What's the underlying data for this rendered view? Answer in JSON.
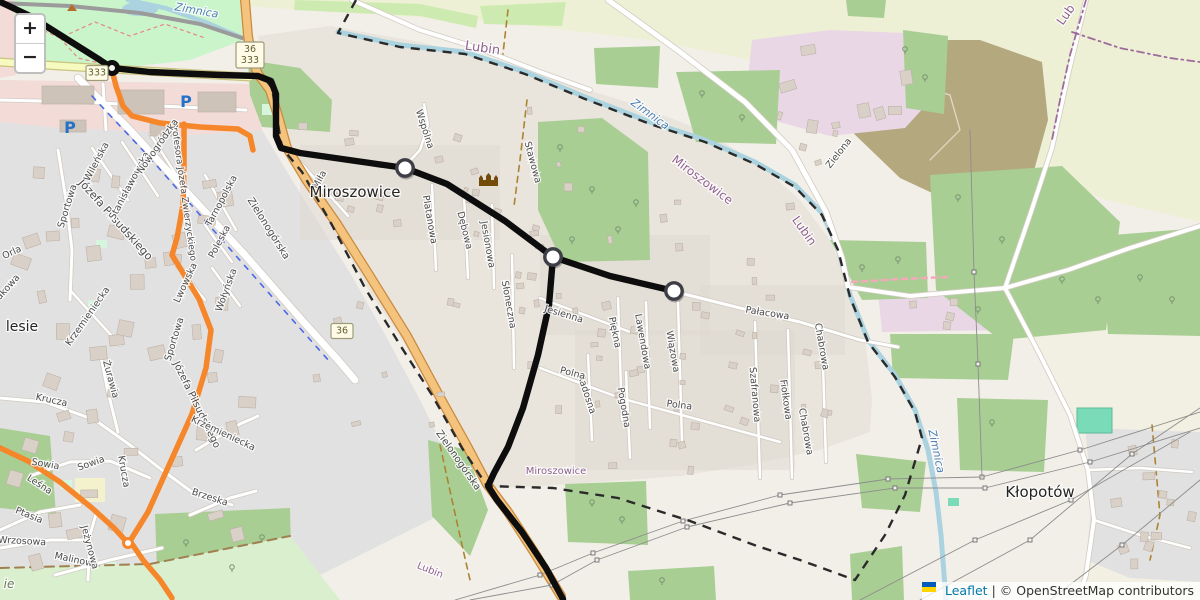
{
  "app": {
    "title": "Leaflet Map — Miroszowice / Lubin"
  },
  "controls": {
    "zoom_in_label": "+",
    "zoom_out_label": "−"
  },
  "attribution": {
    "leaflet_label": "Leaflet",
    "separator": "|",
    "osm_label": "© OpenStreetMap contributors"
  },
  "colors": {
    "base": "#f2efe9",
    "residential": "#e2e1e1",
    "village_bg": "#e9e5dd",
    "village_patch": "#ddd8d0",
    "commercial": "#f3dcd8",
    "industrial": "#e9d7e6",
    "farmland": "#eef0d5",
    "farmland_se": "#f0f0dd",
    "brownfield": "#b4a87f",
    "park": "#caf4ca",
    "forest": "#a9ce94",
    "grass": "#cdebb0",
    "allotment": "#d9efce",
    "pitch": "#7adbb8",
    "mint": "#d5f5dc",
    "school": "#f4f2cc",
    "water": "#aad3df",
    "building": "#d9d0c8",
    "building_stroke": "#bdb2a7",
    "mall_building": "#cdc3b8",
    "road_white": "#ffffff",
    "road_casing": "#d1cbc2",
    "road_primary": "#f4c37d",
    "road_primary_casing": "#c98a3d",
    "road_secondary": "#f7fabf",
    "road_secondary_casing": "#c9c37f",
    "road_gray": "#9b9b9b",
    "track": "#ac8331",
    "fence": "#a08050",
    "path_red": "#e88585",
    "cycleway": "#3355e8",
    "construction_pink": "#f4a9b8",
    "route_black": "#0d0d0d",
    "route_orange": "#f5862a",
    "marker_fill": "#ffffff",
    "marker_ring": "#3e3e46",
    "boundary_black": "#2a2a2a",
    "boundary_purple": "#9d6c9d",
    "power": "#8d8d8d",
    "label_street": "#4b4b4b",
    "label_place": "#252525",
    "label_place_green": "#6a7a5a",
    "label_water": "#4d80b3",
    "label_boundary": "#8e618e",
    "shield_bg": "#fffbe6",
    "shield_border": "#9c9c7a",
    "shield_text": "#5f5f33",
    "parking_blue": "#2471c8",
    "castle_brown": "#734a08",
    "peak_brown": "#b06f2a",
    "tree": "#7a9471",
    "flag_blue": "#005bbb",
    "flag_yellow": "#ffd500"
  },
  "shields": [
    {
      "lines": [
        "36",
        "333"
      ],
      "x": 250,
      "y": 55
    },
    {
      "lines": [
        "333"
      ],
      "x": 97,
      "y": 73
    },
    {
      "lines": [
        "36"
      ],
      "x": 342,
      "y": 331
    }
  ],
  "route": {
    "waypoints": [
      {
        "x": 405,
        "y": 168
      },
      {
        "x": 553,
        "y": 257
      },
      {
        "x": 674,
        "y": 291
      }
    ],
    "roundabout": {
      "x": 112,
      "y": 68
    },
    "orange_junction": {
      "x": 128,
      "y": 543
    }
  },
  "icons": {
    "parking_label": "P",
    "parking": [
      {
        "x": 186,
        "y": 107
      },
      {
        "x": 70,
        "y": 133
      }
    ],
    "castle": {
      "x": 487,
      "y": 180
    },
    "peak": {
      "x": 72,
      "y": 8
    }
  },
  "labels": {
    "places": [
      {
        "text": "Miroszowice",
        "x": 355,
        "y": 197,
        "r": 0,
        "s": 15
      },
      {
        "text": "Kłopotów",
        "x": 1040,
        "y": 497,
        "r": 0,
        "s": 15
      },
      {
        "text": "lesie",
        "x": 22,
        "y": 331,
        "r": 0,
        "s": 14
      },
      {
        "text": "ie",
        "x": 9,
        "y": 588,
        "r": 0,
        "s": 12,
        "italic": true,
        "green": true
      }
    ],
    "boundaries": [
      {
        "text": "Lubin",
        "x": 482,
        "y": 52,
        "r": 8,
        "s": 13
      },
      {
        "text": "Miroszowice",
        "x": 700,
        "y": 183,
        "r": 37,
        "s": 12
      },
      {
        "text": "Lubin",
        "x": 801,
        "y": 233,
        "r": 55,
        "s": 12
      },
      {
        "text": "Miroszowice",
        "x": 556,
        "y": 474,
        "r": 0,
        "s": 10
      },
      {
        "text": "Lubin",
        "x": 429,
        "y": 573,
        "r": 22,
        "s": 10
      },
      {
        "text": "Lub",
        "x": 1069,
        "y": 17,
        "r": -55,
        "s": 12
      }
    ],
    "water": [
      {
        "text": "Zimnica",
        "x": 196,
        "y": 14,
        "r": 10,
        "s": 11
      },
      {
        "text": "Zimnica",
        "x": 648,
        "y": 117,
        "r": 36,
        "s": 11
      },
      {
        "text": "Zimnica",
        "x": 933,
        "y": 452,
        "r": 78,
        "s": 11
      }
    ],
    "streets": [
      {
        "text": "Józefa Piłsudskiego",
        "x": 113,
        "y": 222,
        "r": 48,
        "s": 11
      },
      {
        "text": "Józefa Piłsudskiego",
        "x": 194,
        "y": 406,
        "r": 64,
        "s": 10
      },
      {
        "text": "Profesora Józefa Zwierzyckiego",
        "x": 181,
        "y": 192,
        "r": 82,
        "s": 9
      },
      {
        "text": "Sportowa",
        "x": 70,
        "y": 207,
        "r": -73,
        "s": 9.5
      },
      {
        "text": "Sportowa",
        "x": 177,
        "y": 340,
        "r": -73,
        "s": 9.5
      },
      {
        "text": "Orla",
        "x": 13,
        "y": 255,
        "r": -25,
        "s": 9.5
      },
      {
        "text": "Wileńska",
        "x": 99,
        "y": 163,
        "r": -62,
        "s": 9.5
      },
      {
        "text": "Stanisławowska",
        "x": 132,
        "y": 187,
        "r": -62,
        "s": 9.5
      },
      {
        "text": "Nowogródzka",
        "x": 160,
        "y": 148,
        "r": -55,
        "s": 9.5
      },
      {
        "text": "Tarnopolska",
        "x": 224,
        "y": 202,
        "r": -62,
        "s": 9.5
      },
      {
        "text": "Poleska",
        "x": 222,
        "y": 243,
        "r": -62,
        "s": 9.5
      },
      {
        "text": "Lwowska",
        "x": 188,
        "y": 284,
        "r": -65,
        "s": 9.5
      },
      {
        "text": "Wołyńska",
        "x": 229,
        "y": 291,
        "r": -70,
        "s": 9.5
      },
      {
        "text": "Krzemieniecka",
        "x": 90,
        "y": 318,
        "r": -55,
        "s": 9.5
      },
      {
        "text": "Krzemieniecka",
        "x": 222,
        "y": 436,
        "r": 25,
        "s": 9.5
      },
      {
        "text": "Leśna",
        "x": 38,
        "y": 487,
        "r": 33,
        "s": 9.5
      },
      {
        "text": "Żurawia",
        "x": 108,
        "y": 380,
        "r": 75,
        "s": 9.5
      },
      {
        "text": "Krucza",
        "x": 51,
        "y": 403,
        "r": 12,
        "s": 9.5
      },
      {
        "text": "Krucza",
        "x": 121,
        "y": 472,
        "r": 80,
        "s": 9.5
      },
      {
        "text": "Sowia",
        "x": 45,
        "y": 467,
        "r": 10,
        "s": 9.5
      },
      {
        "text": "Sowia",
        "x": 92,
        "y": 466,
        "r": -20,
        "s": 9.5
      },
      {
        "text": "Ptasia",
        "x": 28,
        "y": 518,
        "r": 22,
        "s": 9.5
      },
      {
        "text": "Wrzosowa",
        "x": 22,
        "y": 544,
        "r": 3,
        "s": 9.5
      },
      {
        "text": "Malinowa",
        "x": 76,
        "y": 563,
        "r": 12,
        "s": 9.5
      },
      {
        "text": "Jeżynowa",
        "x": 87,
        "y": 548,
        "r": 75,
        "s": 9.5
      },
      {
        "text": "Brzeska",
        "x": 209,
        "y": 500,
        "r": 18,
        "s": 9.5
      },
      {
        "text": "akowa",
        "x": 10,
        "y": 289,
        "r": -48,
        "s": 9.5
      },
      {
        "text": "Miła",
        "x": 322,
        "y": 181,
        "r": -62,
        "s": 9.5
      },
      {
        "text": "Wspólna",
        "x": 422,
        "y": 130,
        "r": 72,
        "s": 9.5
      },
      {
        "text": "Platanowa",
        "x": 427,
        "y": 220,
        "r": 80,
        "s": 9.5
      },
      {
        "text": "Dębowa",
        "x": 462,
        "y": 231,
        "r": 76,
        "s": 9.5
      },
      {
        "text": "Jesionowa",
        "x": 485,
        "y": 245,
        "r": 80,
        "s": 9.5
      },
      {
        "text": "Stawowa",
        "x": 530,
        "y": 163,
        "r": 75,
        "s": 9.5
      },
      {
        "text": "Słoneczna",
        "x": 506,
        "y": 305,
        "r": 80,
        "s": 9.5
      },
      {
        "text": "Jesienna",
        "x": 563,
        "y": 317,
        "r": 17,
        "s": 9.5
      },
      {
        "text": "Piękna",
        "x": 612,
        "y": 333,
        "r": 78,
        "s": 9.5
      },
      {
        "text": "Lawendowa",
        "x": 640,
        "y": 342,
        "r": 80,
        "s": 9.5
      },
      {
        "text": "Wiązowa",
        "x": 670,
        "y": 352,
        "r": 80,
        "s": 9.5
      },
      {
        "text": "Radosna",
        "x": 584,
        "y": 395,
        "r": 72,
        "s": 9.5
      },
      {
        "text": "Pogodna",
        "x": 621,
        "y": 408,
        "r": 80,
        "s": 9.5
      },
      {
        "text": "Polna",
        "x": 572,
        "y": 376,
        "r": 14,
        "s": 9.5
      },
      {
        "text": "Polna",
        "x": 679,
        "y": 408,
        "r": 7,
        "s": 9.5
      },
      {
        "text": "Szafranowa",
        "x": 752,
        "y": 395,
        "r": 85,
        "s": 9.5
      },
      {
        "text": "Fiołkowa",
        "x": 783,
        "y": 400,
        "r": 82,
        "s": 9.5
      },
      {
        "text": "Chabrowa",
        "x": 819,
        "y": 347,
        "r": 80,
        "s": 9.5
      },
      {
        "text": "Chabrowa",
        "x": 803,
        "y": 432,
        "r": 80,
        "s": 9.5
      },
      {
        "text": "Pałacowa",
        "x": 767,
        "y": 316,
        "r": 9,
        "s": 9.5
      },
      {
        "text": "Zielona",
        "x": 841,
        "y": 155,
        "r": -52,
        "s": 9.5
      },
      {
        "text": "Zielonogórska",
        "x": 266,
        "y": 230,
        "r": 58,
        "s": 10
      },
      {
        "text": "Zielonogórska",
        "x": 456,
        "y": 462,
        "r": 55,
        "s": 10
      }
    ]
  }
}
